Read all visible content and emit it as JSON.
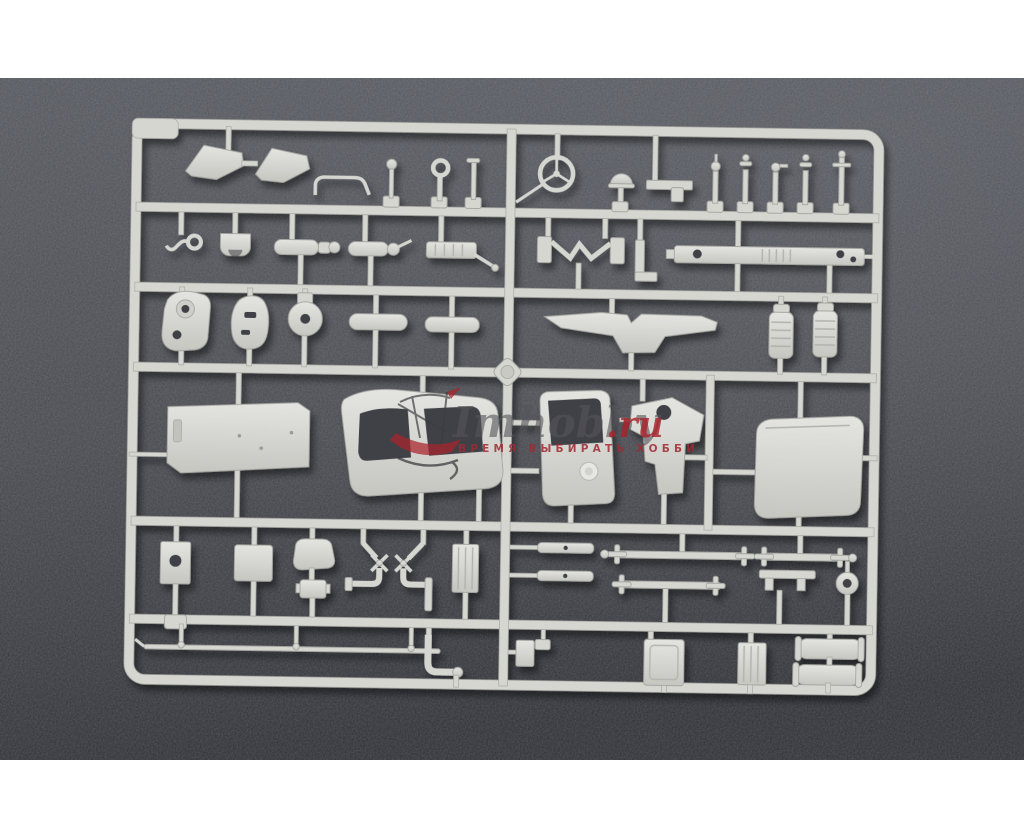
{
  "page": {
    "background": "#ffffff"
  },
  "photo": {
    "description": "Injection-molded plastic model kit sprue (truck parts tree) photographed on dark gray speckled background",
    "background_top": "#55585e",
    "background_mid": "#46484e",
    "background_bottom": "#2f3137",
    "plastic_color": "#d6d6d1",
    "plastic_highlight": "#e4e4e0",
    "plastic_shade": "#c6c6c1",
    "hole_color": "#3f4147"
  },
  "watermark": {
    "logo_icon": "sailing-ship-icon",
    "title_main": "Imhobby",
    "title_suffix": ".ru",
    "subtitle": "ВРЕМЯ ВЫБИРАТЬ   ХОББИ",
    "title_color": "#55555a",
    "suffix_color": "#a8232b",
    "subtitle_color": "#a02a32"
  },
  "sprue": {
    "parts": [
      "corner-tab",
      "mud-flap-a",
      "mud-flap-b",
      "grab-handle",
      "gear-lever",
      "ring-eyelet",
      "shift-lever",
      "steering-wheel",
      "horn-dome",
      "angle-plate",
      "valve-knob-1",
      "valve-knob-2",
      "valve-knob-3",
      "valve-knob-4",
      "valve-knob-5",
      "tow-hook",
      "cradle-bracket",
      "cylinder-small-a",
      "cylinder-small-b",
      "cylinder-finned",
      "engine-mount",
      "corner-bracket",
      "chassis-beam",
      "transfer-case",
      "axle-housing",
      "gear-hub",
      "pod-cylinder-a",
      "pod-cylinder-b",
      "cross-member-wing",
      "air-filter-a",
      "air-filter-b",
      "floor-panel",
      "cab-rear-wall",
      "cab-door",
      "hinge-bracket",
      "fender-panel",
      "plate-with-hole",
      "mounting-plate",
      "seat-back",
      "seat-cushion",
      "valve-pipe-a",
      "valve-pipe-b",
      "radiator-core",
      "spring-leaf-a",
      "spring-leaf-b",
      "drive-shaft-a",
      "drive-shaft-b",
      "drive-shaft-c",
      "axle-bracket",
      "pulley-wheel",
      "tie-rod",
      "elbow-pipe",
      "spine-bracket",
      "tank-bracket-box",
      "ribbed-plate",
      "fuel-tank-a",
      "fuel-tank-b"
    ]
  }
}
